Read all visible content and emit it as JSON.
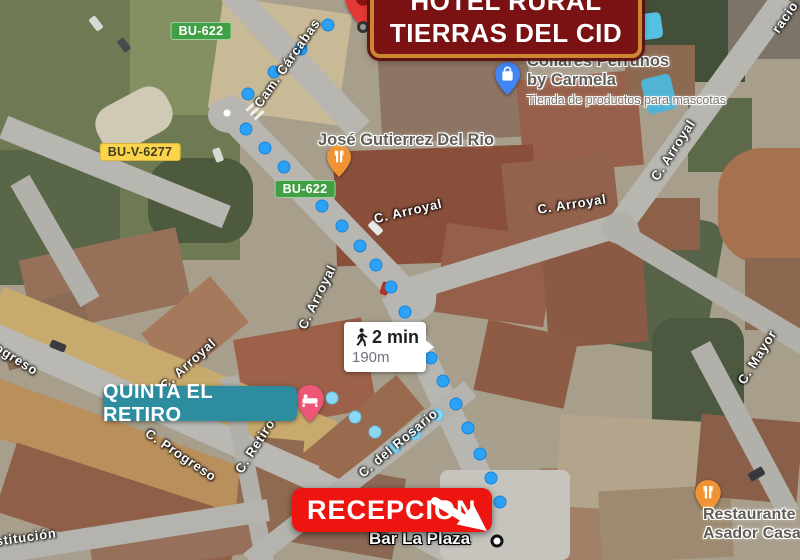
{
  "map": {
    "banners": {
      "hotel": {
        "line1": "HOTEL RURAL",
        "line2": "TIERRAS DEL CID",
        "bg": "#7a1113",
        "border": "#cc8531"
      },
      "quinta": {
        "label": "QUINTA EL RETIRO",
        "bg": "#2d8d9f"
      },
      "recepcion": {
        "label": "RECEPCION",
        "bg": "#ee1510"
      }
    },
    "route": {
      "duration": "2 min",
      "distance": "190m",
      "dot_color": "#2da1f6",
      "alt_dot_color": "#8ad8f4",
      "main_dots": [
        [
          328,
          25
        ],
        [
          301,
          49
        ],
        [
          274,
          72
        ],
        [
          248,
          94
        ],
        [
          246,
          129
        ],
        [
          265,
          148
        ],
        [
          284,
          167
        ],
        [
          303,
          187
        ],
        [
          322,
          206
        ],
        [
          342,
          226
        ],
        [
          360,
          246
        ],
        [
          376,
          265
        ],
        [
          391,
          287
        ],
        [
          405,
          312
        ],
        [
          419,
          337
        ],
        [
          431,
          358
        ],
        [
          443,
          381
        ],
        [
          456,
          404
        ],
        [
          468,
          428
        ],
        [
          480,
          454
        ],
        [
          491,
          478
        ],
        [
          500,
          502
        ]
      ],
      "alt_dots": [
        [
          332,
          398
        ],
        [
          355,
          417
        ],
        [
          375,
          432
        ],
        [
          395,
          447
        ],
        [
          415,
          434
        ],
        [
          437,
          415
        ]
      ],
      "waypoint_dots": [
        [
          227,
          113
        ]
      ]
    },
    "road_badges": [
      {
        "text": "BU-622",
        "type": "green",
        "x": 201,
        "y": 31
      },
      {
        "text": "BU-V-6277",
        "type": "yellow",
        "x": 140,
        "y": 152
      },
      {
        "text": "BU-622",
        "type": "green",
        "x": 305,
        "y": 189
      }
    ],
    "street_labels": [
      {
        "text": "Cam. Cárcabas",
        "x": 287,
        "y": 63,
        "rot": -55
      },
      {
        "text": "C. Arroyal",
        "x": 408,
        "y": 211,
        "rot": -13
      },
      {
        "text": "C. Arroyal",
        "x": 572,
        "y": 204,
        "rot": -9
      },
      {
        "text": "C. Arroyal",
        "x": 673,
        "y": 150,
        "rot": -57
      },
      {
        "text": "C. Arroyal",
        "x": 317,
        "y": 297,
        "rot": -64
      },
      {
        "text": "C. Arroyal",
        "x": 188,
        "y": 364,
        "rot": -42
      },
      {
        "text": "C. del Rosario",
        "x": 398,
        "y": 443,
        "rot": -40
      },
      {
        "text": "C. Progreso",
        "x": 181,
        "y": 455,
        "rot": 34
      },
      {
        "text": "C. Retiro",
        "x": 255,
        "y": 446,
        "rot": -57
      },
      {
        "text": "Progreso",
        "x": 10,
        "y": 355,
        "rot": 32
      },
      {
        "text": "stitución",
        "x": 26,
        "y": 537,
        "rot": -8
      },
      {
        "text": "C. Mayor",
        "x": 757,
        "y": 357,
        "rot": -58
      },
      {
        "text": "racio",
        "x": 785,
        "y": 17,
        "rot": -55
      }
    ],
    "pins": [
      {
        "id": "hotel",
        "glyph": "circle",
        "color": "#e53935",
        "tip_x": 363,
        "tip_y": 28,
        "w": 36,
        "h": 46
      },
      {
        "id": "collares",
        "glyph": "shopping",
        "color": "#4285f4",
        "tip_x": 507,
        "tip_y": 95,
        "w": 25,
        "h": 33
      },
      {
        "id": "jose",
        "glyph": "restaurant",
        "color": "#f09433",
        "tip_x": 339,
        "tip_y": 177,
        "w": 24,
        "h": 32
      },
      {
        "id": "quinta",
        "glyph": "bed",
        "color": "#ee5677",
        "tip_x": 310,
        "tip_y": 422,
        "w": 28,
        "h": 37
      },
      {
        "id": "restaurante",
        "glyph": "restaurant",
        "color": "#f09433",
        "tip_x": 708,
        "tip_y": 514,
        "w": 26,
        "h": 34
      }
    ],
    "pois": {
      "collares": {
        "line1": "Collares Perrunos",
        "line2": "by Carmela",
        "sub": "Tienda de productos para mascotas"
      },
      "jose": {
        "line1": "José Gutierrez Del Rio"
      },
      "restaurante": {
        "line1": "Restaurante",
        "line2": "Asador Casa C"
      },
      "bar": {
        "line1": "Bar La Plaza"
      }
    }
  }
}
